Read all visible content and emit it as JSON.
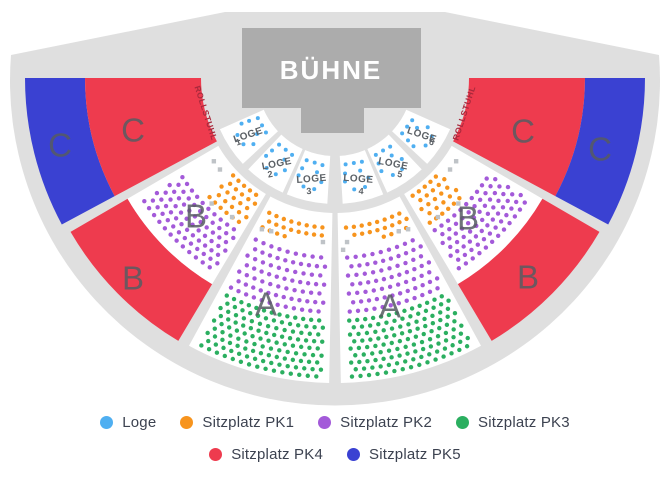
{
  "colors": {
    "fan": "#DFDFDF",
    "stage": "#ACACAC",
    "stage_text": "#FFFFFF",
    "white_section": "#FFFFFF",
    "section_label": "#575C62",
    "loge_text": "#5C6166",
    "rollstuhl_text": "#A8293C",
    "wheelchair_icon": "#9CA1A7",
    "companion_square": "#BFC3C7",
    "loge": "#4FAFF1",
    "pk1": "#F7941D",
    "pk2": "#A35AD9",
    "pk3": "#2BAF60",
    "pk4": "#EE3B4E",
    "pk5": "#3A41D2"
  },
  "stage": {
    "label": "BÜHNE"
  },
  "rollstuhl": {
    "label": "ROLLSTUHL"
  },
  "sections": [
    {
      "id": "c-outer-left",
      "label": "C",
      "category": "pk5"
    },
    {
      "id": "c-inner-left",
      "label": "C",
      "category": "pk4"
    },
    {
      "id": "b-red-left",
      "label": "B",
      "category": "pk4"
    },
    {
      "id": "b-seats-left",
      "label": "B",
      "seat_categories": [
        "pk1",
        "pk2"
      ]
    },
    {
      "id": "a-left",
      "label": "A",
      "seat_categories": [
        "pk1",
        "pk2",
        "pk3"
      ]
    },
    {
      "id": "a-right",
      "label": "A",
      "seat_categories": [
        "pk1",
        "pk2",
        "pk3"
      ]
    },
    {
      "id": "b-seats-right",
      "label": "B",
      "seat_categories": [
        "pk1",
        "pk2"
      ]
    },
    {
      "id": "b-red-right",
      "label": "B",
      "category": "pk4"
    },
    {
      "id": "c-inner-right",
      "label": "C",
      "category": "pk4"
    },
    {
      "id": "c-outer-right",
      "label": "C",
      "category": "pk5"
    }
  ],
  "loges": [
    {
      "label": "LOGE",
      "number": "1"
    },
    {
      "label": "LOGE",
      "number": "2"
    },
    {
      "label": "LOGE",
      "number": "3"
    },
    {
      "label": "LOGE",
      "number": "4"
    },
    {
      "label": "LOGE",
      "number": "5"
    },
    {
      "label": "LOGE",
      "number": "6"
    }
  ],
  "legend": {
    "rows": [
      [
        {
          "label": "Loge",
          "color": "loge"
        },
        {
          "label": "Sitzplatz PK1",
          "color": "pk1"
        },
        {
          "label": "Sitzplatz PK2",
          "color": "pk2"
        },
        {
          "label": "Sitzplatz PK3",
          "color": "pk3"
        }
      ],
      [
        {
          "label": "Sitzplatz PK4",
          "color": "pk4"
        },
        {
          "label": "Sitzplatz PK5",
          "color": "pk5"
        }
      ]
    ]
  }
}
